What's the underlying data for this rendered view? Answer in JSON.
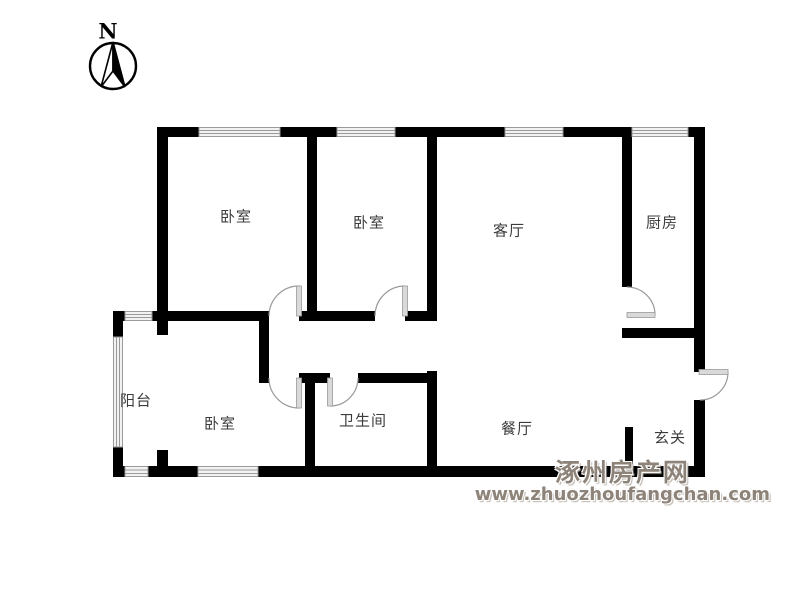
{
  "compass": {
    "label": "N"
  },
  "rooms": [
    {
      "id": "bedroom-1",
      "label": "卧室"
    },
    {
      "id": "bedroom-2",
      "label": "卧室"
    },
    {
      "id": "living-room",
      "label": "客厅"
    },
    {
      "id": "kitchen",
      "label": "厨房"
    },
    {
      "id": "balcony",
      "label": "阳台"
    },
    {
      "id": "bedroom-3",
      "label": "卧室"
    },
    {
      "id": "bathroom",
      "label": "卫生间"
    },
    {
      "id": "dining-room",
      "label": "餐厅"
    },
    {
      "id": "entry-hall",
      "label": "玄关"
    }
  ],
  "watermark": {
    "site_name": "涿州房产网",
    "site_url": "www.zhuozhoufangchan.com",
    "color": "#8d8379"
  },
  "colors": {
    "background": "#ffffff",
    "wall": "#000000",
    "window_line": "#9a9a9a",
    "door": "#9a9a9a",
    "label": "#3c3c3c"
  }
}
